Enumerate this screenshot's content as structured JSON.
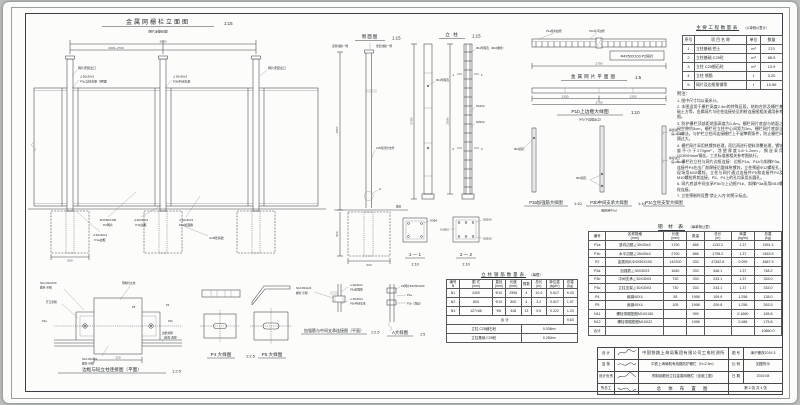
{
  "elevation": {
    "title": "金属网栅栏立面图",
    "scale": "1:15",
    "subtitle": "（网片涂塑处理）",
    "dim_total": "3000",
    "dim_panel": "2400~2700",
    "dim_found": "600",
    "label_slot_left": "网片安装企口",
    "label_slot_right": "网片安装企口",
    "angle_spec": "∠30x30x3",
    "label_p3c": "P3c立柱支架（预埋）",
    "label_p3b": "P3b中间支承",
    "label_p2_spec": "Φ4X50X100",
    "label_p2": "P2网片",
    "label_p1b": "P1b边框",
    "label_p3a": "P3a加强筋",
    "label_p1a": "P1a边框",
    "label_foundation": "C25砼基础"
  },
  "side_view": {
    "title": "侧面图",
    "scale": "1:15",
    "label_far": "远离线路一侧",
    "label_near": "靠近线路一侧",
    "label_bracket": "C25现浇砼支托",
    "label_marker": "A",
    "label_ground": "路肩",
    "dim_width": "600",
    "dim_height": "1800",
    "dim_depth": "500"
  },
  "column_view": {
    "title": "立 柱",
    "scale": "1:15",
    "label_hole": "Φ12预留孔",
    "label_hole2": "Φ12预留孔（M10螺栓）",
    "label_n1": "N1Φ10",
    "label_n2": "N2Φ10",
    "cut1": "1",
    "cut2": "2",
    "dim_h1": "2750",
    "dim_h2": "2590"
  },
  "sections": {
    "s1_title": "1 — 1",
    "s1_scale": "1:10",
    "s2_title": "2 — 2",
    "s2_scale": "1:10",
    "label_n3": "N3Φ6",
    "label_n1": "N1Φ10",
    "label_n2": "N2Φ10"
  },
  "mesh_plan": {
    "title": "金属网片平面图",
    "scale": "1:5",
    "label_p1a": "P1a竖向边框",
    "label_p1b": "P1b水平边框",
    "box_label": "Φ4X50X100 P2网片",
    "dim_total": "2700"
  },
  "p1b_detail": {
    "title": "P1b上边框大样图",
    "scale": "1:10",
    "subtitle": "（P1b下边框反之）",
    "dim_half1": "1350",
    "dim_half2": "1350",
    "dim_total": "2700"
  },
  "p3_details": {
    "p3a_title": "P3a加强筋大样图",
    "p3a_scale": "1:10",
    "hole_label": "Φ10圆孔",
    "p3b_title": "P3b中间支承大样图",
    "p3b_subtitle": "（结构参P3c）",
    "p3b_scale": "1:10",
    "hole_label2": "Φ10圆孔",
    "p3c_title": "P3c立柱支架大样图",
    "notch_label1": "焊接缺口",
    "notch_label2": "（深≤10mm）",
    "notch_label3": "焊接缺口",
    "notch_label4": "（深≤10mm）"
  },
  "conn_detail": {
    "title": "边框与砼立柱连接图（平面）",
    "scale": "1:2.5",
    "label_bolt_top": "N11 M10x150",
    "label_bolt_top2": "螺栓·带帽",
    "label_post": "预制砼立柱",
    "label_washer": "开口垫圈",
    "label_p5": "P5",
    "label_p4": "P4",
    "label_p1a": "P1a",
    "label_p1b": "P1b",
    "label_bolt_bottom": "N12 M10x22",
    "label_bolt_bottom2": "螺栓·带帽",
    "label_weld": "边框角钢",
    "label_weld2": "（双面·满焊）",
    "dim": "120"
  },
  "p45_details": {
    "p4_title": "P4 大样图",
    "scale": "1:2.5",
    "p5_title": "P5 大样图"
  },
  "stif_detail": {
    "title": "加强筋与中间支承连接图（平面）",
    "scale": "1:2.5",
    "label_bolt": "N12 M10x22",
    "label_bolt2": "螺栓·带帽",
    "label_a1": "∠30x30x3",
    "label_a1b": "P3a加强筋",
    "label_a2": "∠30x30x3",
    "label_a2b": "P3b中间支承"
  },
  "a_detail": {
    "title": "A大样图",
    "scale": "1:5",
    "label_p2": "P2网片Φ4X50X100",
    "label_p1a": "P1a",
    "label_p1b": "P1b（焊接）"
  },
  "quantity_table": {
    "title": "主要工程数量表",
    "unit_note": "（以单侧公里计）",
    "headers": [
      "序号",
      "项 目 名 称",
      "单位",
      "数量"
    ],
    "rows": [
      [
        "1",
        "立柱基础 挖土",
        "m³",
        "270"
      ],
      [
        "2",
        "立柱基础 C25砼",
        "m³",
        "85.9"
      ],
      [
        "3",
        "立柱 C25细石砼",
        "m³",
        "13.9"
      ],
      [
        "4",
        "立柱 钢筋",
        "t",
        "3.20"
      ],
      [
        "5",
        "网片及边框角钢等",
        "t",
        "10.86"
      ]
    ]
  },
  "notes": {
    "heading": "附注：",
    "items": [
      "1. 图中尺寸均以毫米计。",
      "2. 本图适用于栅栏高度2.3m的特殊区段，结构台阶及栅栏基础土方等，金属网片与砼柱连接处见附桩连接图相关通用参考图。",
      "3. 防护栅栏顶部距地面高度为1.8m，栅栏网片底部与地面之间空隙约5cm，栅栏砼立柱中心间距为3m，栅栏网片底部企口做法，与护栏立柱间连接栅栏上不留攀爬条件，防止栅栏间隔过大。",
      "4. 栅栏网片采用热镀锌处理，而后再进行塑料涂覆处理，镀锌量不小于270g/m²，涂塑厚度0.8~1.2mm，钢丝采用Q235Φ4mm钢丝，工艺标准按相关参考图执行。",
      "5. 栅栏砼立柱与网片边框连接：边框P1a、P1b与斜撑P3a、连接件P4在出厂前焊接后整体热镀锌，立柱预留Φ12螺栓孔，现场用M10螺栓，立柱与网片通过连接件P5和连接件P4及M10螺栓将其连接，P5、P4上的孔均采用长圆孔。",
      "6. 网片底部中间支承P3b与上边框P1b、斜撑P3a采用M10螺栓连接。",
      "7. 立柱预制时设置“禁止入内”的警示标志。"
    ]
  },
  "steel_table": {
    "title": "钢 材 表",
    "unit_note": "（每单侧公里）",
    "headers": [
      "编号",
      "名称规格\n(mm)",
      "长度\n(mm)",
      "数量",
      "总长\n(m)",
      "单重\n(kg/m)",
      "总重\n(kg)"
    ],
    "rows": [
      [
        "P1a",
        "竖向边框∠30x30x3",
        "1700",
        "666",
        "1132.2",
        "1.37",
        "1551.1"
      ],
      [
        "P1b",
        "水平边框∠30x30x3",
        "2700",
        "666",
        "1798.2",
        "1.37",
        "2463.5"
      ],
      [
        "P2",
        "金属网片Φ4X50X100",
        "142200",
        "333",
        "47352.6",
        "0.099",
        "4687.9"
      ],
      [
        "P3a",
        "加强筋∠30X30X3",
        "1640",
        "333",
        "546.1",
        "1.37",
        "748.2"
      ],
      [
        "P3b",
        "中间支承∠30X30X3",
        "730",
        "333",
        "243.1",
        "1.37",
        "333.0"
      ],
      [
        "P3c",
        "立柱支架∠30X30X3",
        "730",
        "333",
        "243.1",
        "1.37",
        "333.0"
      ],
      [
        "P4",
        "扁钢40X4",
        "55",
        "1998",
        "109.9",
        "1.256",
        "138.0"
      ],
      [
        "P5",
        "扁钢40X4",
        "105",
        "1998",
        "209.8",
        "1.256",
        "263.5"
      ],
      [
        "N11",
        "螺栓带帽垫圈M10X150",
        "",
        "999",
        "",
        "0.1660",
        "165.8"
      ],
      [
        "N12",
        "螺栓带帽垫圈M10X22",
        "",
        "1998",
        "",
        "0.088",
        "175.8"
      ],
      [
        "合计",
        "",
        "",
        "",
        "",
        "",
        "10860.0"
      ]
    ]
  },
  "rebar_table": {
    "title": "立柱钢筋数量表",
    "unit_note": "（每根）",
    "headers": [
      "编号\nN",
      "图 式\n(mm)",
      "直径\n(mm)",
      "长度\n(mm)",
      "根数",
      "总长\n(m)",
      "单位重\n(kg/m)",
      "总重\n(kg)"
    ],
    "rows": [
      [
        "N1",
        "2400",
        "Φ10",
        "2596",
        "4",
        "10.4",
        "0.617",
        "6.43"
      ],
      [
        "N2",
        "800",
        "Φ10",
        "800",
        "4",
        "3.2",
        "0.617",
        "1.97"
      ],
      [
        "N3",
        "127×66",
        "Φ6",
        "426",
        "13",
        "5.5",
        "0.222",
        "1.23"
      ]
    ],
    "total_label": "合 计",
    "total_value": "9.63",
    "footer1_label": "立柱 C25细石砼",
    "footer1_value": "0.036m³",
    "footer2_label": "立柱基础 C25砼",
    "footer2_value": "0.250m³"
  },
  "title_block": {
    "row1_label": "设 计",
    "row2_label": "复 核",
    "row3_label": "设计负责",
    "row4_label": "所总工",
    "company": "中国铁路上海局集团有限公司工电检测所",
    "project": "中铁上海局既有线路防护栅栏（H=2.3m）",
    "subject": "预制钢筋砼立柱金属网栅栏（含施工图）",
    "sheet_name": "总 体 布 置 图",
    "fig_label": "图 号",
    "fig_value": "津沪栅改2019-3",
    "scale_label": "比 例",
    "scale_value": "如图所示",
    "date_label": "日 期",
    "date_value": "2019.08",
    "page_info": "第 2 张 共 4 张"
  }
}
